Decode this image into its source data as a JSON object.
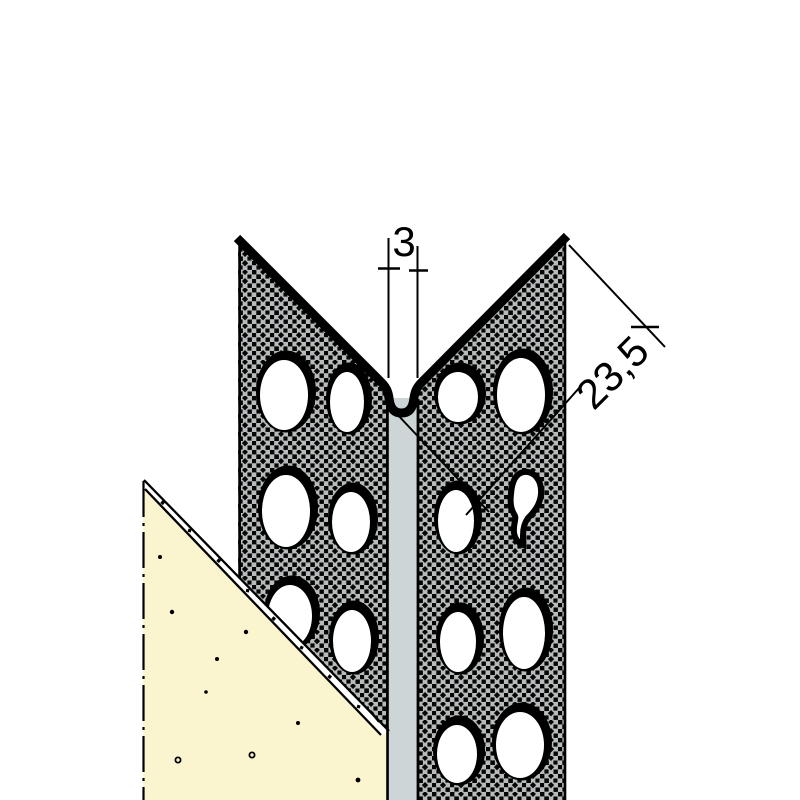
{
  "diagram": {
    "type": "technical-drawing",
    "subject": "perforated-corner-bead-profile-with-plaster",
    "dimensions": {
      "gap_width": {
        "label": "3"
      },
      "flange_length": {
        "label": "23,5"
      }
    },
    "perforation_hole_count": 14,
    "colors": {
      "background": "#ffffff",
      "line": "#000000",
      "perforated_flange_fill": "#b7bbbc",
      "bead_strip_fill": "#cdd5d6",
      "plaster_fill": "#faf5cf",
      "hole_fill": "#ffffff",
      "edge_gap_fill": "#ffffff"
    }
  }
}
